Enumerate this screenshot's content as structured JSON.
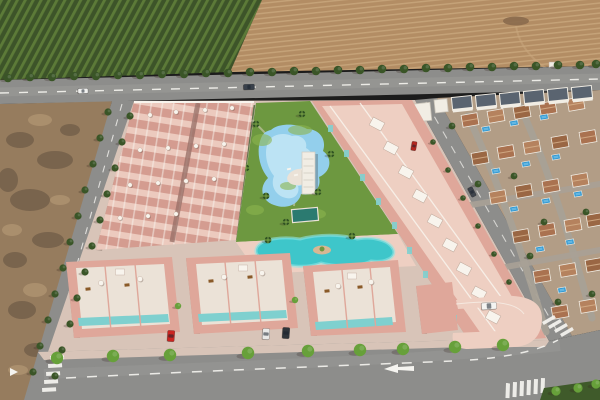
{
  "palette": {
    "orchard_dark": "#3d5429",
    "orchard_light": "#5c7a38",
    "field_tan": "#b38d64",
    "field_light": "#cbaa80",
    "road_gray": "#8d8d8b",
    "road_light": "#b0b0ae",
    "marking_white": "#f5f4f0",
    "dirt_base": "#967c5e",
    "dirt_dark": "#564739",
    "dirt_light": "#bb9f7a",
    "paving": "#d8c4b8",
    "paving_dark": "#bfa99c",
    "alley": "#9a7168",
    "wall_pink": "#dfa79a",
    "unit_pink": "#d49c90",
    "unit_light": "#eccabe",
    "roof_pink": "#eecfc2",
    "deck_white": "#ebe2d7",
    "trim_white": "#f8f4ed",
    "teal_glass": "#7fd0cf",
    "lawn": "#6d9840",
    "lawn_light": "#8cb44e",
    "pool_blue": "#93cfec",
    "pool_light": "#c9e9f7",
    "lap_teal": "#2b7a70",
    "lagoon": "#3ec6ca",
    "lagoon_light": "#8fe4e2",
    "sand": "#d8b793",
    "tree_dark": "#3a5527",
    "tree_bright": "#67a03a",
    "palm": "#2f5222",
    "village_ground": "#b29d86",
    "village_street": "#a8a196",
    "terracotta_a": "#aa7250",
    "terracotta_b": "#b5825e",
    "terracotta_c": "#9a6744",
    "roof_ridge": "#d9b48e",
    "white_wall": "#f1ede4",
    "dark_roof": "#5a6470",
    "village_pool": "#2e97d2",
    "village_pool_light": "#7cc4e8",
    "hedge": "#3f5a2a",
    "path_light": "#dacfc0",
    "furniture_brown": "#8a5a28",
    "track_tan": "#c9a87e",
    "shadow": "rgba(50,35,28,0.25)"
  },
  "scene": {
    "orchard": {
      "poly": "0,0 262,0 230,72 0,80"
    },
    "field": {
      "poly": "262,0 600,0 600,66 230,72",
      "track": "M516,26 C520,52 545,72 565,76",
      "debris": [
        516,
        21
      ],
      "shed": [
        549,
        62
      ]
    },
    "main_road": {
      "poly": "0,80 600,66 600,90 0,104",
      "centerline": "M0,93 L600,79",
      "sheen": "M0,92 L600,78"
    },
    "dirt": {
      "poly": "0,104 112,101 30,400 0,400",
      "dark": [
        [
          20,
          140,
          14,
          8
        ],
        [
          55,
          160,
          18,
          9
        ],
        [
          30,
          200,
          20,
          11
        ],
        [
          70,
          130,
          10,
          6
        ],
        [
          15,
          260,
          12,
          8
        ],
        [
          48,
          240,
          16,
          8
        ],
        [
          22,
          310,
          14,
          9
        ],
        [
          8,
          180,
          10,
          12
        ],
        [
          36,
          350,
          12,
          7
        ]
      ],
      "light": [
        [
          40,
          120,
          12,
          6
        ],
        [
          12,
          230,
          10,
          6
        ],
        [
          35,
          290,
          12,
          7
        ],
        [
          60,
          200,
          10,
          5
        ],
        [
          18,
          370,
          10,
          5
        ]
      ]
    },
    "avenue": {
      "poly": "112,101 134,101 52,400 24,400",
      "dashes": "M122,104 L40,396"
    },
    "right_road": {
      "poly": "415,100 437,98 572,336 549,341",
      "dashes": "M426,102 L560,336"
    },
    "village": {
      "poly": "437,98 600,90 600,330 572,336",
      "streets": [
        "M468,116 C498,180 522,252 546,332",
        "M520,106 C550,172 572,244 592,318",
        "M452,208 L600,184",
        "M478,272 L600,250"
      ],
      "houses": [
        [
          470,
          120
        ],
        [
          496,
          116
        ],
        [
          522,
          112
        ],
        [
          548,
          108
        ],
        [
          576,
          104
        ],
        [
          480,
          158
        ],
        [
          506,
          152
        ],
        [
          532,
          147
        ],
        [
          560,
          142
        ],
        [
          588,
          137
        ],
        [
          498,
          197
        ],
        [
          524,
          191
        ],
        [
          551,
          186
        ],
        [
          580,
          180
        ],
        [
          521,
          236
        ],
        [
          547,
          230
        ],
        [
          573,
          225
        ],
        [
          595,
          220
        ],
        [
          542,
          276
        ],
        [
          568,
          270
        ],
        [
          594,
          265
        ],
        [
          560,
          312
        ],
        [
          588,
          306
        ]
      ],
      "pools": [
        [
          486,
          129
        ],
        [
          514,
          123
        ],
        [
          544,
          117
        ],
        [
          496,
          171
        ],
        [
          526,
          164
        ],
        [
          556,
          157
        ],
        [
          514,
          209
        ],
        [
          546,
          201
        ],
        [
          578,
          194
        ],
        [
          540,
          249
        ],
        [
          570,
          242
        ],
        [
          562,
          290
        ]
      ],
      "trees": [
        [
          452,
          126
        ],
        [
          478,
          184
        ],
        [
          514,
          176
        ],
        [
          544,
          222
        ],
        [
          586,
          212
        ],
        [
          530,
          256
        ],
        [
          558,
          302
        ],
        [
          592,
          294
        ]
      ],
      "white_blocks": [
        [
          462,
          103
        ],
        [
          486,
          101
        ],
        [
          510,
          99
        ],
        [
          534,
          97
        ],
        [
          558,
          95
        ],
        [
          582,
          93
        ]
      ],
      "white_villas": [
        [
          414,
          104,
          16,
          18
        ],
        [
          434,
          100,
          13,
          13
        ]
      ]
    },
    "development": {
      "base_poly": "134,101 415,100 549,341 470,346 48,352",
      "block_a": {
        "poly": "134,102 254,102 236,240 96,250",
        "alley": "M198,103 L172,242",
        "topline": "M134,102 L254,102",
        "parasols": [
          [
            150,
            115
          ],
          [
            176,
            112
          ],
          [
            205,
            110
          ],
          [
            232,
            108
          ],
          [
            140,
            150
          ],
          [
            168,
            148
          ],
          [
            196,
            146
          ],
          [
            224,
            144
          ],
          [
            130,
            185
          ],
          [
            158,
            183
          ],
          [
            186,
            181
          ],
          [
            214,
            179
          ],
          [
            120,
            218
          ],
          [
            148,
            216
          ],
          [
            176,
            214
          ]
        ]
      },
      "block_c": {
        "poly": "312,101 412,100 546,338 471,344",
        "roof_poly": "322,106 402,104 532,332 484,338",
        "parapets": [
          "M330,106 L500,338",
          "M360,103 L528,334"
        ],
        "windows": [
          [
            328,
            125
          ],
          [
            344,
            150
          ],
          [
            360,
            174
          ],
          [
            376,
            198
          ],
          [
            392,
            222
          ],
          [
            407,
            247
          ],
          [
            423,
            271
          ],
          [
            439,
            295
          ],
          [
            452,
            315
          ]
        ],
        "roof_boxes": [
          [
            377,
            124
          ],
          [
            391,
            148
          ],
          [
            406,
            172
          ],
          [
            420,
            196
          ],
          [
            435,
            221
          ],
          [
            450,
            245
          ],
          [
            464,
            269
          ],
          [
            479,
            293
          ],
          [
            493,
            317
          ]
        ],
        "roadside_trees": [
          [
            433,
            142
          ],
          [
            448,
            170
          ],
          [
            463,
            198
          ],
          [
            478,
            226
          ],
          [
            494,
            254
          ],
          [
            509,
            282
          ],
          [
            524,
            310
          ]
        ]
      },
      "villas": [
        {
          "poly": "66,262 172,257 180,332 74,338",
          "roof": "76,268 164,264 170,324 82,329",
          "teal": "78,318 168,314 169,322 79,326",
          "dividers": "M105,266 L111,331 M135,264 L141,329"
        },
        {
          "poly": "186,258 290,253 298,328 194,334",
          "roof": "196,264 282,260 288,320 202,325",
          "teal": "198,314 286,310 287,318 199,322",
          "dividers": "M225,262 L231,327 M255,260 L261,324"
        },
        {
          "poly": "303,266 398,260 406,332 311,336",
          "roof": "313,272 390,267 396,322 319,328",
          "teal": "315,322 392,317 393,325 316,330",
          "dividers": "M342,270 L348,333 M370,267 L376,330"
        }
      ],
      "villa_parasols": [
        [
          101,
          283
        ],
        [
          140,
          279
        ],
        [
          224,
          277
        ],
        [
          262,
          273
        ],
        [
          338,
          286
        ],
        [
          371,
          282
        ]
      ],
      "villa_furniture": [
        [
          88,
          289
        ],
        [
          127,
          285
        ],
        [
          211,
          281
        ],
        [
          250,
          277
        ],
        [
          327,
          291
        ],
        [
          360,
          287
        ]
      ],
      "villa_roofboxes": [
        [
          120,
          272
        ],
        [
          243,
          268
        ],
        [
          352,
          276
        ]
      ],
      "gap_trees": [
        [
          178,
          306
        ],
        [
          295,
          300
        ]
      ],
      "garage_poly": "416,286 452,282 458,330 422,334",
      "ramp_path": "M456,300 L498,296 C528,294 542,302 542,318 C542,336 532,346 514,347 L468,349 C456,349 451,342 453,333 L500,331 C512,330 516,322 510,314 C506,308 498,306 488,307 L458,309 Z",
      "ramp_edge": "M456,304 C490,300 516,302 524,314"
    },
    "garden": {
      "poly": "256,103 310,101 398,234 236,242",
      "hedge": "M254,105 L235,240",
      "lawn_patches": [
        [
          262,
          140,
          10,
          6
        ],
        [
          300,
          130,
          12,
          5
        ],
        [
          255,
          210,
          9,
          5
        ],
        [
          316,
          214,
          10,
          5
        ],
        [
          288,
          186,
          8,
          4
        ]
      ],
      "walk": "M252,120 C278,144 298,172 294,206",
      "pool_path": "M262,136 C256,148 258,166 268,178 C258,188 262,201 274,205 C287,210 299,204 301,194 C313,197 322,188 319,177 C331,172 333,158 323,151 C327,139 319,129 307,129 C297,123 278,123 271,130 C266,131 264,133 262,136 Z",
      "pool_inner": "M268,142 C264,152 266,166 274,176 C270,186 276,196 286,198 C296,200 300,192 298,186 C306,186 312,178 308,170 C316,164 314,152 306,148 C308,140 300,134 292,136 C284,132 272,134 268,142 Z",
      "deck": [
        299,
        177
      ],
      "loungers": [
        [
          289,
          169
        ],
        [
          296,
          175
        ],
        [
          303,
          169
        ]
      ],
      "structure": [
        302,
        152,
        13,
        42
      ],
      "lap": [
        305,
        215
      ],
      "palms": [
        [
          256,
          124
        ],
        [
          302,
          114
        ],
        [
          266,
          196
        ],
        [
          318,
          192
        ],
        [
          246,
          168
        ],
        [
          331,
          154
        ],
        [
          286,
          222
        ]
      ]
    },
    "lagoon": {
      "deck_poly": "236,242 398,234 416,266 258,274",
      "path": "M257,247 C262,239 282,236 300,239 C318,234 342,234 357,239 C374,236 389,241 393,249 C397,257 386,263 371,261 C359,267 336,267 321,263 C305,269 283,266 274,260 C261,260 253,255 257,247 Z",
      "island": [
        322,
        250
      ],
      "deck_palms": [
        [
          268,
          240
        ],
        [
          352,
          236
        ]
      ]
    },
    "bottom_road": {
      "poly": "26,400 38,352 468,340 549,341 572,336 600,330 600,400",
      "sidewalk": "38,352 468,340 549,341 545,347 464,347 44,360",
      "trees": [
        [
          57,
          358
        ],
        [
          113,
          356
        ],
        [
          170,
          355
        ],
        [
          248,
          353
        ],
        [
          308,
          351
        ],
        [
          360,
          350
        ],
        [
          403,
          349
        ],
        [
          455,
          347
        ],
        [
          503,
          345
        ]
      ],
      "dashes": [
        "M66,378 C220,370 360,365 452,361",
        "M470,360 C510,357 540,350 558,340"
      ],
      "sheen": "M44,374 C240,366 420,360 560,346",
      "arrow": "384,369 398,364 398,367 414,366 414,371 398,370 398,373",
      "yield": "10,368 18,372 10,376",
      "cross_left": [
        [
          50,
          356
        ],
        [
          48,
          364
        ],
        [
          46,
          372
        ],
        [
          44,
          380
        ],
        [
          42,
          388
        ]
      ],
      "cross_right": [
        [
          542,
          322
        ],
        [
          548,
          326
        ],
        [
          554,
          330
        ],
        [
          560,
          334
        ]
      ],
      "cross_bottom": [
        [
          506,
          383
        ],
        [
          513,
          382
        ],
        [
          520,
          381
        ],
        [
          527,
          380
        ],
        [
          534,
          379
        ],
        [
          541,
          378
        ]
      ],
      "hedge_poly": "544,388 600,380 600,400 540,400",
      "hedge_trees": [
        [
          556,
          391
        ],
        [
          578,
          388
        ],
        [
          596,
          384
        ]
      ]
    },
    "trees": {
      "road": [
        [
          8,
          78
        ],
        [
          30,
          77
        ],
        [
          52,
          77
        ],
        [
          74,
          76
        ],
        [
          96,
          76
        ],
        [
          118,
          75
        ],
        [
          140,
          75
        ],
        [
          162,
          74
        ],
        [
          184,
          74
        ],
        [
          206,
          73
        ],
        [
          228,
          73
        ],
        [
          250,
          72
        ],
        [
          272,
          72
        ],
        [
          294,
          71
        ],
        [
          316,
          71
        ],
        [
          338,
          70
        ],
        [
          360,
          70
        ],
        [
          382,
          69
        ],
        [
          404,
          69
        ],
        [
          426,
          68
        ],
        [
          448,
          68
        ],
        [
          470,
          67
        ],
        [
          492,
          67
        ],
        [
          514,
          66
        ],
        [
          536,
          66
        ],
        [
          558,
          65
        ],
        [
          580,
          65
        ],
        [
          596,
          64
        ]
      ],
      "avenue_left": [
        [
          108,
          112
        ],
        [
          100,
          138
        ],
        [
          93,
          164
        ],
        [
          85,
          190
        ],
        [
          78,
          216
        ],
        [
          70,
          242
        ],
        [
          63,
          268
        ],
        [
          55,
          294
        ],
        [
          48,
          320
        ],
        [
          40,
          346
        ],
        [
          33,
          372
        ]
      ],
      "avenue_right": [
        [
          130,
          116
        ],
        [
          122,
          142
        ],
        [
          115,
          168
        ],
        [
          107,
          194
        ],
        [
          100,
          220
        ],
        [
          92,
          246
        ],
        [
          85,
          272
        ],
        [
          77,
          298
        ],
        [
          70,
          324
        ],
        [
          62,
          350
        ],
        [
          55,
          376
        ]
      ]
    },
    "cars": [
      {
        "name": "car-white-main-road",
        "x": 83,
        "y": 91,
        "w": 10,
        "h": 5,
        "rot": -2,
        "color": "#f0f0ee"
      },
      {
        "name": "van-dark-main-road",
        "x": 249,
        "y": 87,
        "w": 11,
        "h": 5.5,
        "rot": -2,
        "color": "#39414b"
      },
      {
        "name": "car-dark-right-road",
        "x": 472,
        "y": 192,
        "w": 10,
        "h": 5,
        "rot": 62,
        "color": "#3e444c"
      },
      {
        "name": "car-red-village",
        "x": 414,
        "y": 146,
        "w": 5,
        "h": 9,
        "rot": 10,
        "color": "#b3271f"
      },
      {
        "name": "car-red-driveway",
        "x": 171,
        "y": 336,
        "w": 7,
        "h": 11,
        "rot": 4,
        "color": "#cb2420"
      },
      {
        "name": "car-white-driveway",
        "x": 266,
        "y": 334,
        "w": 7,
        "h": 11,
        "rot": 4,
        "color": "#e9e9e7"
      },
      {
        "name": "car-dark-driveway",
        "x": 286,
        "y": 333,
        "w": 7,
        "h": 11,
        "rot": 4,
        "color": "#2f343a"
      },
      {
        "name": "suv-white-ramp",
        "x": 489,
        "y": 306,
        "w": 15,
        "h": 7,
        "rot": -4,
        "color": "#f4f4f2"
      }
    ],
    "shadows": [
      "134,102 140,102 102,251 96,250",
      "312,101 318,101 477,344 471,344",
      "66,262 72,262 80,338 74,338",
      "186,258 192,258 200,334 194,334",
      "303,266 309,266 317,336 311,336",
      "416,286 421,286 427,334 422,334"
    ]
  }
}
